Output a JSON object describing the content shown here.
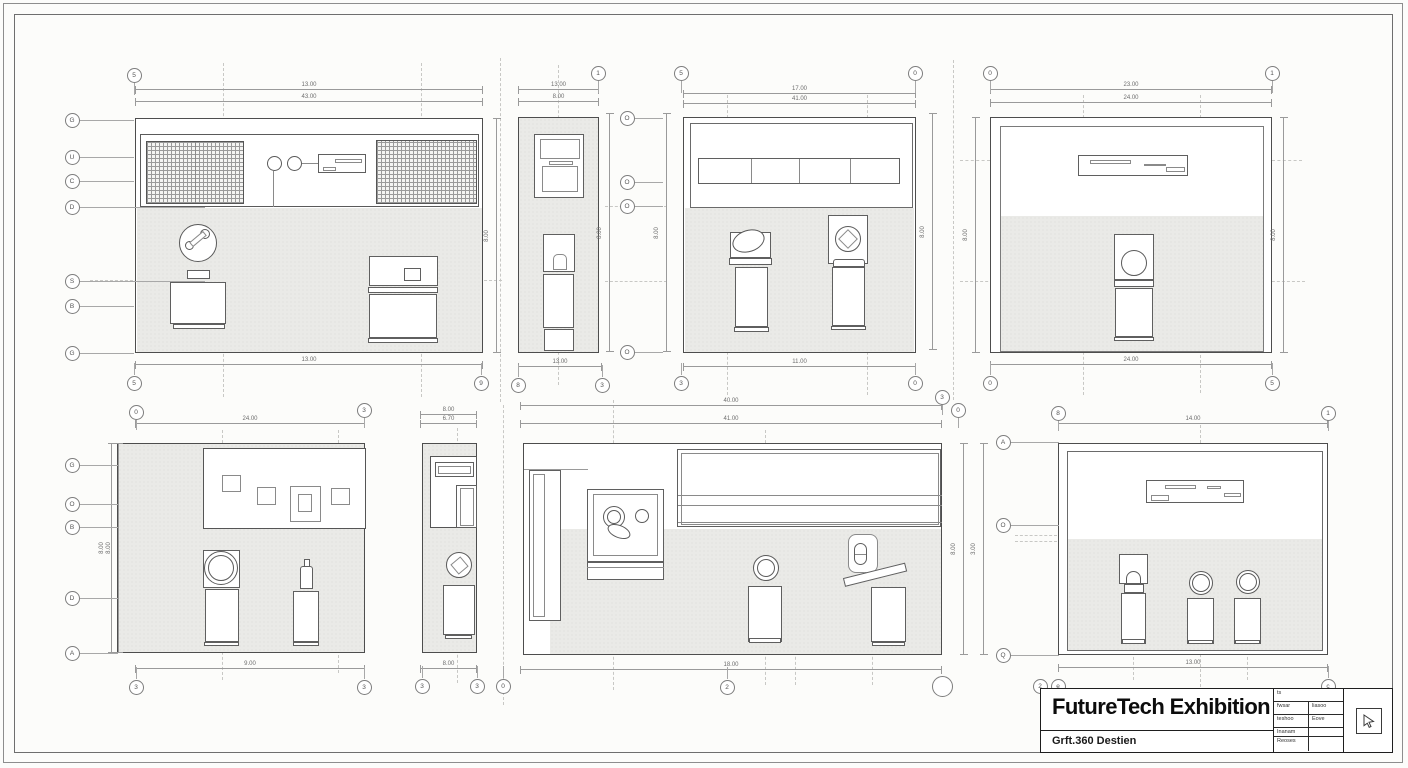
{
  "sheet": {
    "colors": {
      "paper": "#fcfcfa",
      "wall_line": "#4d4d4d",
      "detail_line": "#6e6e6e",
      "fill_gray": "#eaeae7",
      "dim_line": "#9a9a9a",
      "dash_line": "#c8c8c5",
      "title_text": "#0c0c0c"
    },
    "title_block": {
      "title": "FutureTech Exhibition",
      "subtitle": "Grft.360 Destien",
      "info_rows": [
        {
          "c1": "ts",
          "c2": "",
          "span": true
        },
        {
          "c1": "fwsar",
          "c2": "liasoo",
          "span": false
        },
        {
          "c1": "teshoo",
          "c2": "Eove",
          "span": false
        },
        {
          "c1": "Inanam",
          "c2": "",
          "span": false
        },
        {
          "c1": "Reoses",
          "c2": "",
          "span": false
        }
      ]
    }
  },
  "annotations": {
    "bubbles": [
      {
        "x": 134,
        "y": 75,
        "label": "5",
        "leader": "d12"
      },
      {
        "x": 598,
        "y": 73,
        "label": "1",
        "leader": "d12"
      },
      {
        "x": 681,
        "y": 73,
        "label": "5",
        "leader": "d12"
      },
      {
        "x": 915,
        "y": 73,
        "label": "0",
        "leader": "d12"
      },
      {
        "x": 990,
        "y": 73,
        "label": "0",
        "leader": "d12"
      },
      {
        "x": 1272,
        "y": 73,
        "label": "1",
        "leader": "d12"
      },
      {
        "x": 72,
        "y": 120,
        "label": "G",
        "leader": "r54"
      },
      {
        "x": 72,
        "y": 157,
        "label": "U",
        "leader": "r54"
      },
      {
        "x": 72,
        "y": 181,
        "label": "C",
        "leader": "r54"
      },
      {
        "x": 72,
        "y": 207,
        "label": "D",
        "leader": "r125"
      },
      {
        "x": 72,
        "y": 281,
        "label": "S",
        "leader": "r125"
      },
      {
        "x": 72,
        "y": 306,
        "label": "B",
        "leader": "r54"
      },
      {
        "x": 72,
        "y": 353,
        "label": "G",
        "leader": "r54"
      },
      {
        "x": 627,
        "y": 118,
        "label": "O",
        "leader": "r28"
      },
      {
        "x": 627,
        "y": 182,
        "label": "O",
        "leader": "r28"
      },
      {
        "x": 627,
        "y": 206,
        "label": "O",
        "leader": "r28"
      },
      {
        "x": 627,
        "y": 352,
        "label": "O",
        "leader": "r28"
      },
      {
        "x": 134,
        "y": 383,
        "label": "5",
        "leader": "u12"
      },
      {
        "x": 481,
        "y": 383,
        "label": "9",
        "leader": "u12"
      },
      {
        "x": 518,
        "y": 385,
        "label": "8",
        "leader": "u12"
      },
      {
        "x": 602,
        "y": 385,
        "label": "3",
        "leader": "u12"
      },
      {
        "x": 681,
        "y": 383,
        "label": "3",
        "leader": "u12"
      },
      {
        "x": 915,
        "y": 383,
        "label": "0",
        "leader": "u12"
      },
      {
        "x": 990,
        "y": 383,
        "label": "0",
        "leader": "u12"
      },
      {
        "x": 1272,
        "y": 383,
        "label": "5",
        "leader": "u12"
      },
      {
        "x": 136,
        "y": 412,
        "label": "0",
        "leader": "d10"
      },
      {
        "x": 364,
        "y": 410,
        "label": "3",
        "leader": "d10"
      },
      {
        "x": 942,
        "y": 397,
        "label": "3",
        "leader": "d10"
      },
      {
        "x": 958,
        "y": 410,
        "label": "0",
        "leader": "d10"
      },
      {
        "x": 1058,
        "y": 413,
        "label": "8",
        "leader": "d10"
      },
      {
        "x": 1328,
        "y": 413,
        "label": "1",
        "leader": "d10"
      },
      {
        "x": 72,
        "y": 465,
        "label": "G",
        "leader": "r38"
      },
      {
        "x": 72,
        "y": 504,
        "label": "O",
        "leader": "r38"
      },
      {
        "x": 72,
        "y": 527,
        "label": "B",
        "leader": "r38"
      },
      {
        "x": 72,
        "y": 598,
        "label": "D",
        "leader": "r38"
      },
      {
        "x": 72,
        "y": 653,
        "label": "A",
        "leader": "r38"
      },
      {
        "x": 1003,
        "y": 442,
        "label": "A",
        "leader": "r48"
      },
      {
        "x": 1003,
        "y": 525,
        "label": "O",
        "leader": "r48"
      },
      {
        "x": 1003,
        "y": 655,
        "label": "Q",
        "leader": "r48"
      },
      {
        "x": 136,
        "y": 687,
        "label": "3",
        "leader": "u12"
      },
      {
        "x": 364,
        "y": 687,
        "label": "3",
        "leader": "u12"
      },
      {
        "x": 422,
        "y": 686,
        "label": "3",
        "leader": "u12"
      },
      {
        "x": 477,
        "y": 686,
        "label": "3",
        "leader": "u12"
      },
      {
        "x": 503,
        "y": 686,
        "label": "0",
        "leader": "u12"
      },
      {
        "x": 727,
        "y": 687,
        "label": "2",
        "leader": "u12"
      },
      {
        "x": 1040,
        "y": 686,
        "label": "2",
        "leader": ""
      },
      {
        "x": 1058,
        "y": 686,
        "label": "e",
        "leader": ""
      },
      {
        "x": 1328,
        "y": 686,
        "label": "c",
        "leader": "u12"
      },
      {
        "x": 942,
        "y": 686,
        "label": "",
        "leader": "",
        "big": true
      }
    ],
    "h_dims": [
      {
        "x": 135,
        "y": 89,
        "w": 348,
        "label": "13.00"
      },
      {
        "x": 135,
        "y": 101,
        "w": 348,
        "label": "43.00"
      },
      {
        "x": 135,
        "y": 364,
        "w": 348,
        "label": "13.00"
      },
      {
        "x": 518,
        "y": 89,
        "w": 81,
        "label": "13.00"
      },
      {
        "x": 518,
        "y": 101,
        "w": 81,
        "label": "8.00"
      },
      {
        "x": 518,
        "y": 366,
        "w": 84,
        "label": "13.00"
      },
      {
        "x": 683,
        "y": 93,
        "w": 233,
        "label": "17.00"
      },
      {
        "x": 683,
        "y": 103,
        "w": 233,
        "label": "41.00"
      },
      {
        "x": 683,
        "y": 366,
        "w": 233,
        "label": "11.00"
      },
      {
        "x": 990,
        "y": 89,
        "w": 282,
        "label": "23.00"
      },
      {
        "x": 990,
        "y": 102,
        "w": 282,
        "label": "24.00"
      },
      {
        "x": 990,
        "y": 364,
        "w": 282,
        "label": "24.00"
      },
      {
        "x": 135,
        "y": 423,
        "w": 230,
        "label": "24.00"
      },
      {
        "x": 135,
        "y": 668,
        "w": 230,
        "label": "9.00"
      },
      {
        "x": 420,
        "y": 414,
        "w": 57,
        "label": "8.00"
      },
      {
        "x": 420,
        "y": 423,
        "w": 57,
        "label": "6.70"
      },
      {
        "x": 420,
        "y": 668,
        "w": 57,
        "label": "8.00"
      },
      {
        "x": 520,
        "y": 405,
        "w": 422,
        "label": "40.00"
      },
      {
        "x": 520,
        "y": 423,
        "w": 422,
        "label": "41.00"
      },
      {
        "x": 520,
        "y": 669,
        "w": 422,
        "label": "18.00"
      },
      {
        "x": 1058,
        "y": 423,
        "w": 270,
        "label": "14.00"
      },
      {
        "x": 1058,
        "y": 667,
        "w": 270,
        "label": "13.00"
      }
    ],
    "v_dims": [
      {
        "x": 496,
        "y": 118,
        "h": 235,
        "label": "8.00"
      },
      {
        "x": 609,
        "y": 113,
        "h": 239,
        "label": "8.00"
      },
      {
        "x": 666,
        "y": 113,
        "h": 239,
        "label": "8.00"
      },
      {
        "x": 932,
        "y": 113,
        "h": 237,
        "label": "8.00"
      },
      {
        "x": 975,
        "y": 117,
        "h": 236,
        "label": "8.00"
      },
      {
        "x": 1283,
        "y": 117,
        "h": 236,
        "label": "8.00"
      },
      {
        "x": 111,
        "y": 443,
        "h": 210,
        "label": "8.00"
      },
      {
        "x": 118,
        "y": 443,
        "h": 210,
        "label": "8.00"
      },
      {
        "x": 963,
        "y": 443,
        "h": 212,
        "label": "8.00"
      },
      {
        "x": 983,
        "y": 443,
        "h": 212,
        "label": "3.00"
      }
    ],
    "centerlines": {
      "v": [
        [
          223,
          63,
          334
        ],
        [
          421,
          63,
          334
        ],
        [
          500,
          58,
          344
        ],
        [
          558,
          65,
          320
        ],
        [
          727,
          95,
          300
        ],
        [
          867,
          95,
          300
        ],
        [
          953,
          60,
          340
        ],
        [
          1083,
          95,
          300
        ],
        [
          1200,
          95,
          298
        ],
        [
          222,
          430,
          250
        ],
        [
          338,
          430,
          243
        ],
        [
          457,
          428,
          255
        ],
        [
          503,
          405,
          300
        ],
        [
          613,
          400,
          290
        ],
        [
          765,
          430,
          255
        ],
        [
          795,
          450,
          235
        ],
        [
          872,
          450,
          235
        ],
        [
          1133,
          455,
          225
        ],
        [
          1200,
          425,
          262
        ],
        [
          1247,
          455,
          225
        ]
      ],
      "h": [
        [
          90,
          280,
          412
        ],
        [
          605,
          206,
          62
        ],
        [
          605,
          281,
          62
        ],
        [
          960,
          160,
          30
        ],
        [
          1272,
          160,
          30
        ],
        [
          960,
          281,
          345
        ],
        [
          1015,
          535,
          42
        ],
        [
          1015,
          541,
          42
        ]
      ]
    }
  }
}
